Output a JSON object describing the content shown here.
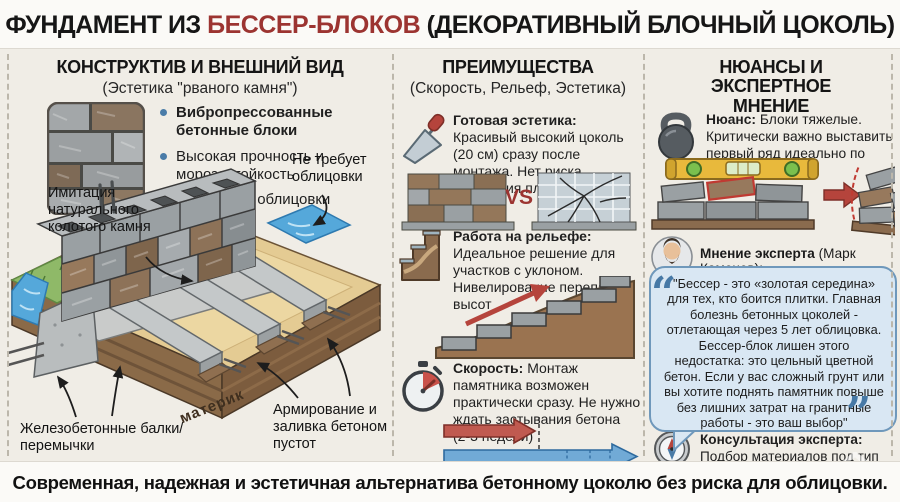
{
  "title": {
    "pre": "ФУНДАМЕНТ ИЗ ",
    "highlight": "БЕССЕР-БЛОКОВ",
    "post": " (ДЕКОРАТИВНЫЙ БЛОЧНЫЙ ЦОКОЛЬ)"
  },
  "footer": {
    "text": "Современная, надежная и эстетичная альтернатива бетонному цоколю без риска для облицовки."
  },
  "left": {
    "heading": "КОНСТРУКТИВ И ВНЕШНИЙ ВИД",
    "subheading": "(Эстетика \"рваного камня\")",
    "bullets": [
      "Вибропрессованные бетонные блоки",
      "Высокая прочность и морозостойкость",
      "Не требует облицовки"
    ],
    "diagram": {
      "label_no_cladding": "Не требует облицовки",
      "label_imitation": "Имитация натурального колотого камня",
      "label_beams": "Железобетонные балки/перемычки",
      "label_soil": "материк",
      "label_reinforcement": "Армирование и заливка бетоном пустот"
    }
  },
  "middle": {
    "heading": "ПРЕИМУЩЕСТВА",
    "subheading": "(Скорость, Рельеф, Эстетика)",
    "vs_label": "VS",
    "items": [
      {
        "icon": "trowel-icon",
        "title": "Готовая эстетика:",
        "text": "Красивый высокий цоколь (20 см) сразу после монтажа. Нет риска отпадания плитки"
      },
      {
        "icon": "stairs-icon",
        "title": "Работа на рельефе:",
        "text": "Идеальное решение для участков с уклоном. Нивелирование перепадов высот"
      },
      {
        "icon": "stopwatch-icon",
        "title": "Скорость:",
        "text": "Монтаж памятника возможен практически сразу. Не нужно ждать застывания бетона (2-3 недели)"
      }
    ]
  },
  "right": {
    "heading": "НЮАНСЫ И ЭКСПЕРТНОЕ МНЕНИЕ",
    "nuance": {
      "icon": "kettlebell-icon",
      "title": "Нюанс:",
      "text": "Блоки тяжелые. Критически важно выставить первый ряд идеально по уровню"
    },
    "expert": {
      "label": "Мнение эксперта",
      "name": " (Марк Каменев):",
      "open_quote": "“",
      "close_quote": "”",
      "quote": "\"Бессер - это «золотая середина» для тех, кто боится плитки. Главная болезнь бетонных цоколей - отлетающая через 5 лет облицовка. Бессер-блок лишен этого недостатка: это цельный цветной бетон. Если у вас сложный грунт или вы хотите поднять памятник повыше без лишних затрат на гранитные работы - это ваш выбор\""
    },
    "consult": {
      "icon": "compass-icon",
      "title": "Консультация эксперта:",
      "text": "Подбор материалов под тип почвы"
    }
  },
  "colors": {
    "accent_red": "#9c3431",
    "bullet_blue": "#4a7ca8",
    "bubble_bg": "#d9e7f3",
    "bubble_border": "#6f98bb"
  }
}
